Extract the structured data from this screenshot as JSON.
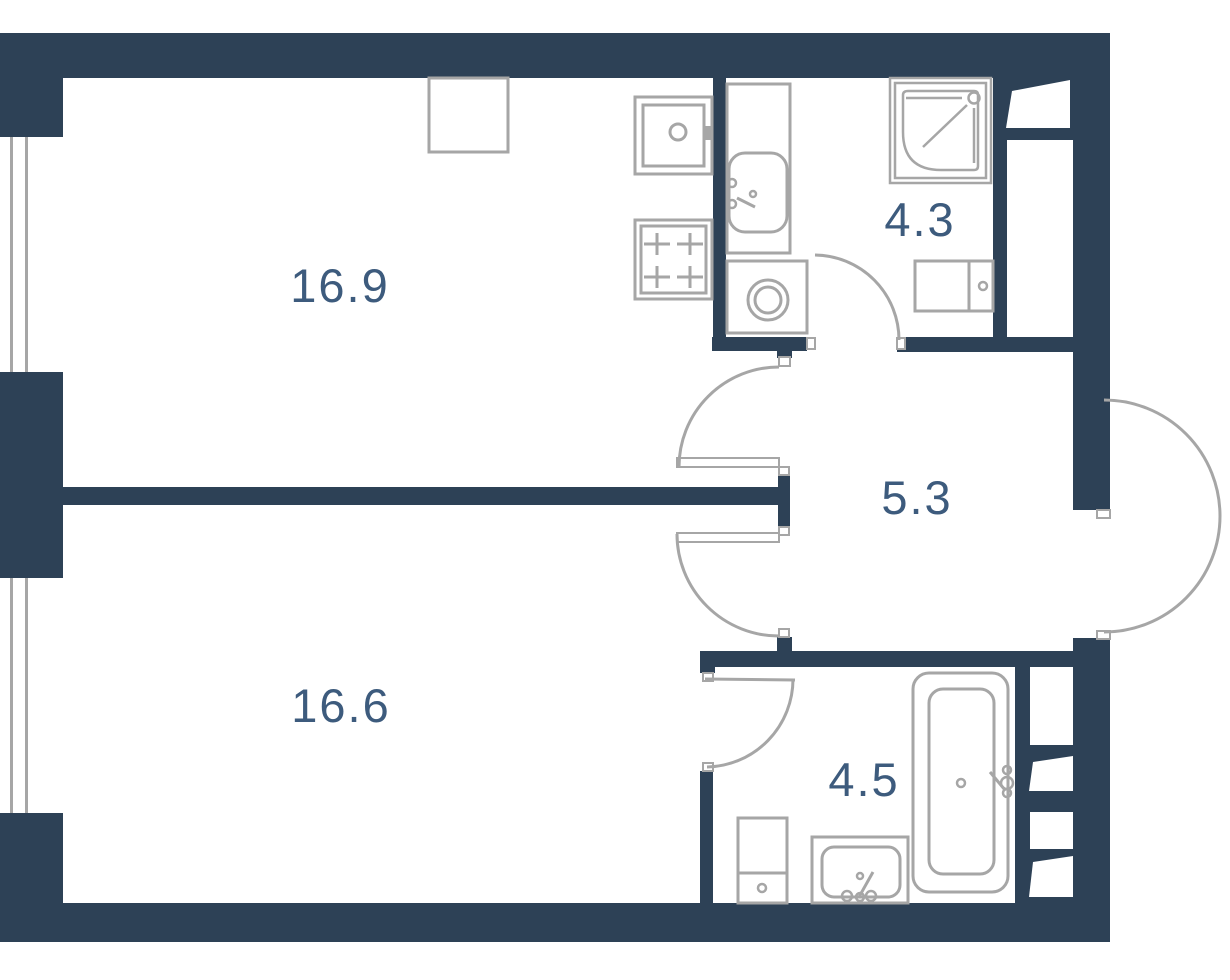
{
  "plan_title": "apartment-floor-plan",
  "colors": {
    "wall": "#2d4156",
    "line": "#a6a6a6",
    "label": "#3d5b7d",
    "background": "#ffffff"
  },
  "rooms": [
    {
      "id": "living-kitchen",
      "area": "16.9"
    },
    {
      "id": "bathroom-top",
      "area": "4.3"
    },
    {
      "id": "hallway",
      "area": "5.3"
    },
    {
      "id": "bedroom",
      "area": "16.6"
    },
    {
      "id": "bathroom-bottom",
      "area": "4.5"
    }
  ]
}
